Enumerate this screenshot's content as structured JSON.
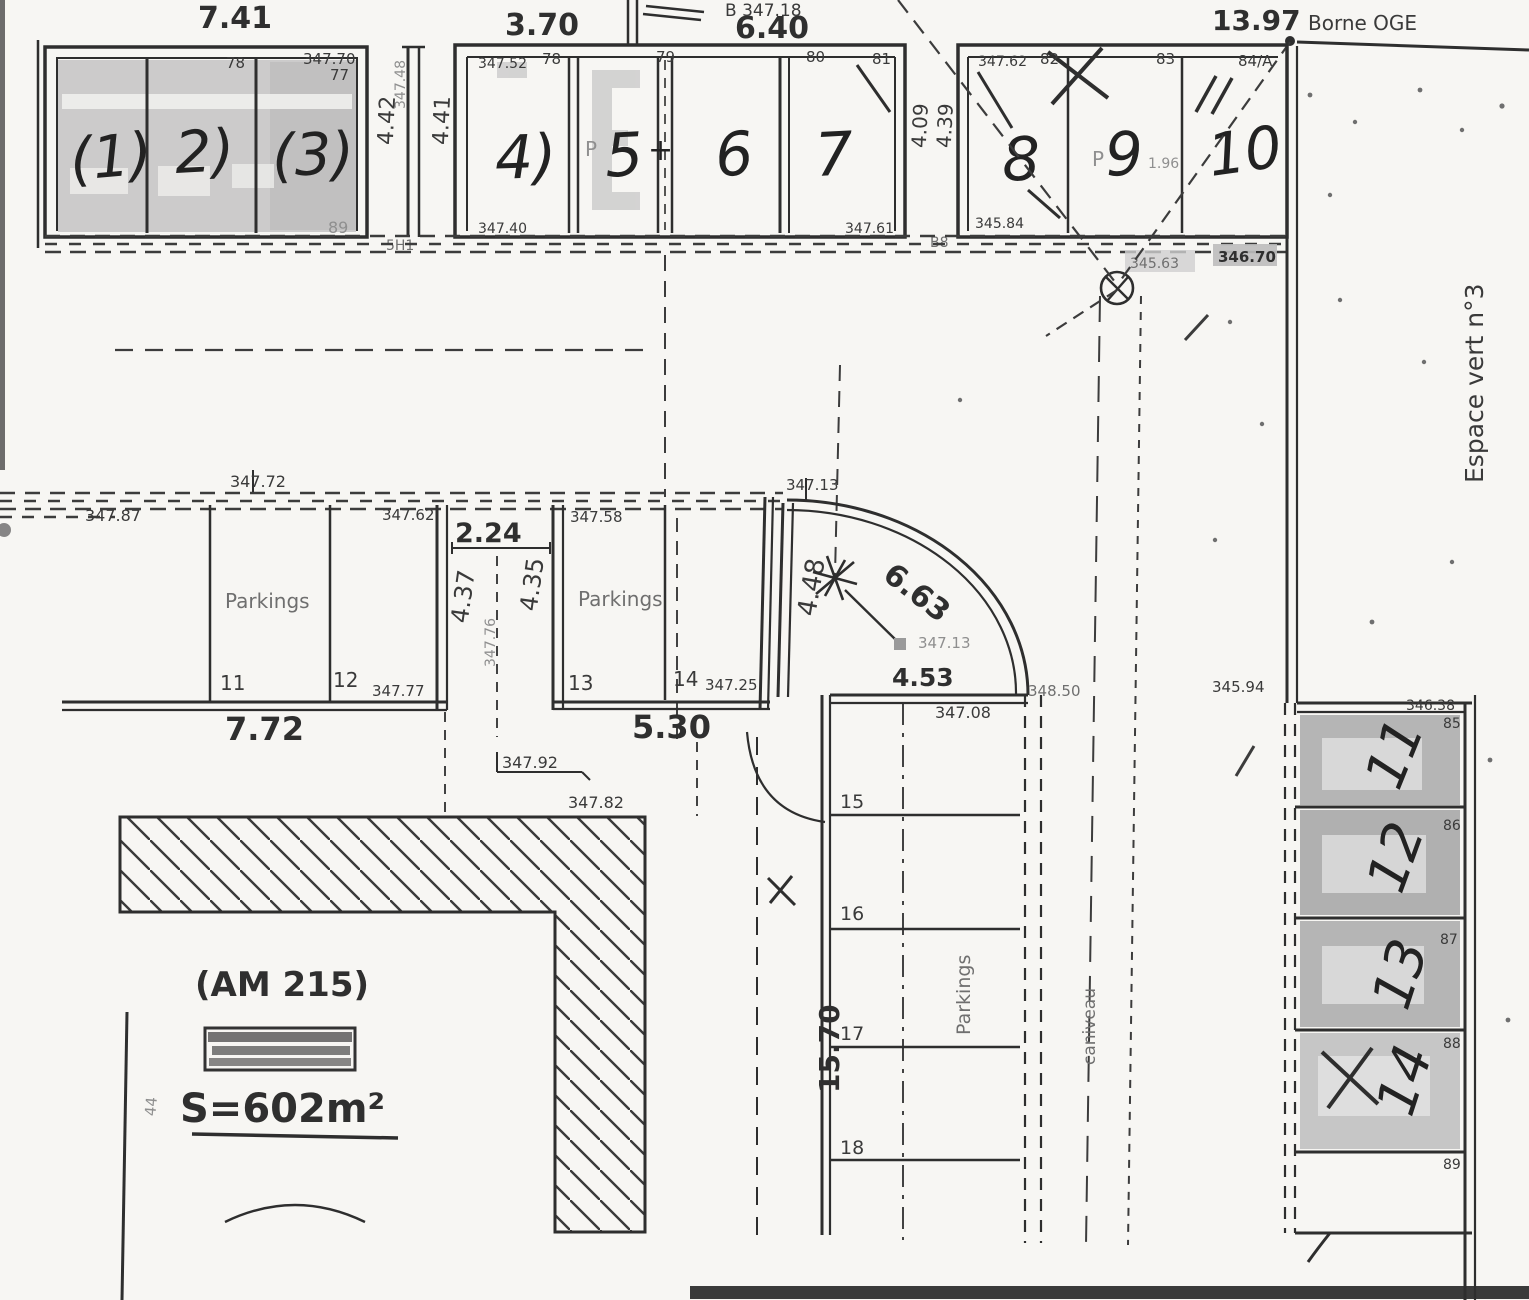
{
  "colors": {
    "ink": "#2e2e2e",
    "paper": "#f7f6f3",
    "highlight": "#c7c7c7",
    "highlight_dark": "#b5b5b5",
    "gray_text": "#8f8f8f",
    "scan_bar": "#3a3a3a"
  },
  "top": {
    "d741": "7.41",
    "d370": "3.70",
    "d640": "6.40",
    "d1397": "13.97",
    "borne": "Borne OGE",
    "pointB": "B 347.18",
    "g1": {
      "n1": "(1)",
      "n2": "2)",
      "n3": "(3)",
      "p78": "78",
      "e34770": "347.70",
      "p77": "77",
      "e89": "89"
    },
    "gap1": {
      "d442": "4.42",
      "d441": "4.41",
      "r34748": "347.48",
      "sh1": "5H1"
    },
    "g2": {
      "n4": "4)",
      "n5": "5",
      "plus": "+",
      "n6": "6",
      "n7": "7",
      "p": "P",
      "e34752": "347.52",
      "p78": "78",
      "p79": "79",
      "p80": "80",
      "p81": "81",
      "e34740": "347.40",
      "e34761": "347.61"
    },
    "gap2": {
      "d409": "4.09",
      "d439": "4.39",
      "b8": "B8"
    },
    "g3": {
      "n8": "8",
      "n9": "9",
      "n10": "10",
      "p": "P",
      "note196": "1.96",
      "e34762": "347.62",
      "p82": "82",
      "p83": "83",
      "p84": "84/A",
      "e34584": "345.84",
      "e34563": "345.63",
      "e34670": "346.70"
    }
  },
  "middle": {
    "e34772": "347.72",
    "e34787": "347.87",
    "e34762": "347.62",
    "e34758": "347.58",
    "e34713": "347.13",
    "left": {
      "label": "Parkings",
      "n11": "11",
      "n12": "12",
      "e34777": "347.77",
      "d772": "7.72"
    },
    "mid": {
      "d224": "2.24",
      "d437": "4.37",
      "d435": "4.35",
      "r34776": "347.76"
    },
    "right": {
      "label": "Parkings",
      "n13": "13",
      "n14": "14",
      "e34725": "347.25",
      "d530": "5.30"
    },
    "arc": {
      "d448": "4.48",
      "d663": "6.63",
      "d453": "4.53",
      "e34713": "347.13",
      "e34850": "348.50"
    }
  },
  "south": {
    "e34708": "347.08",
    "n15": "15",
    "n16": "16",
    "n17": "17",
    "n18": "18",
    "d1570": "15.70",
    "parkings": "Parkings",
    "caniveau": "caniveau"
  },
  "right_col": {
    "espace": "Espace vert n°3",
    "e34594": "345.94",
    "e34638": "346.38",
    "p85": "85",
    "p86": "86",
    "p87": "87",
    "p88": "88",
    "p89": "89",
    "n11": "11",
    "n12": "12",
    "n13": "13",
    "n14": "14"
  },
  "bottom_left": {
    "am": "(AM 215)",
    "surface": "S=602m²",
    "e34792": "347.92",
    "e34782": "347.82",
    "n44": "44"
  }
}
